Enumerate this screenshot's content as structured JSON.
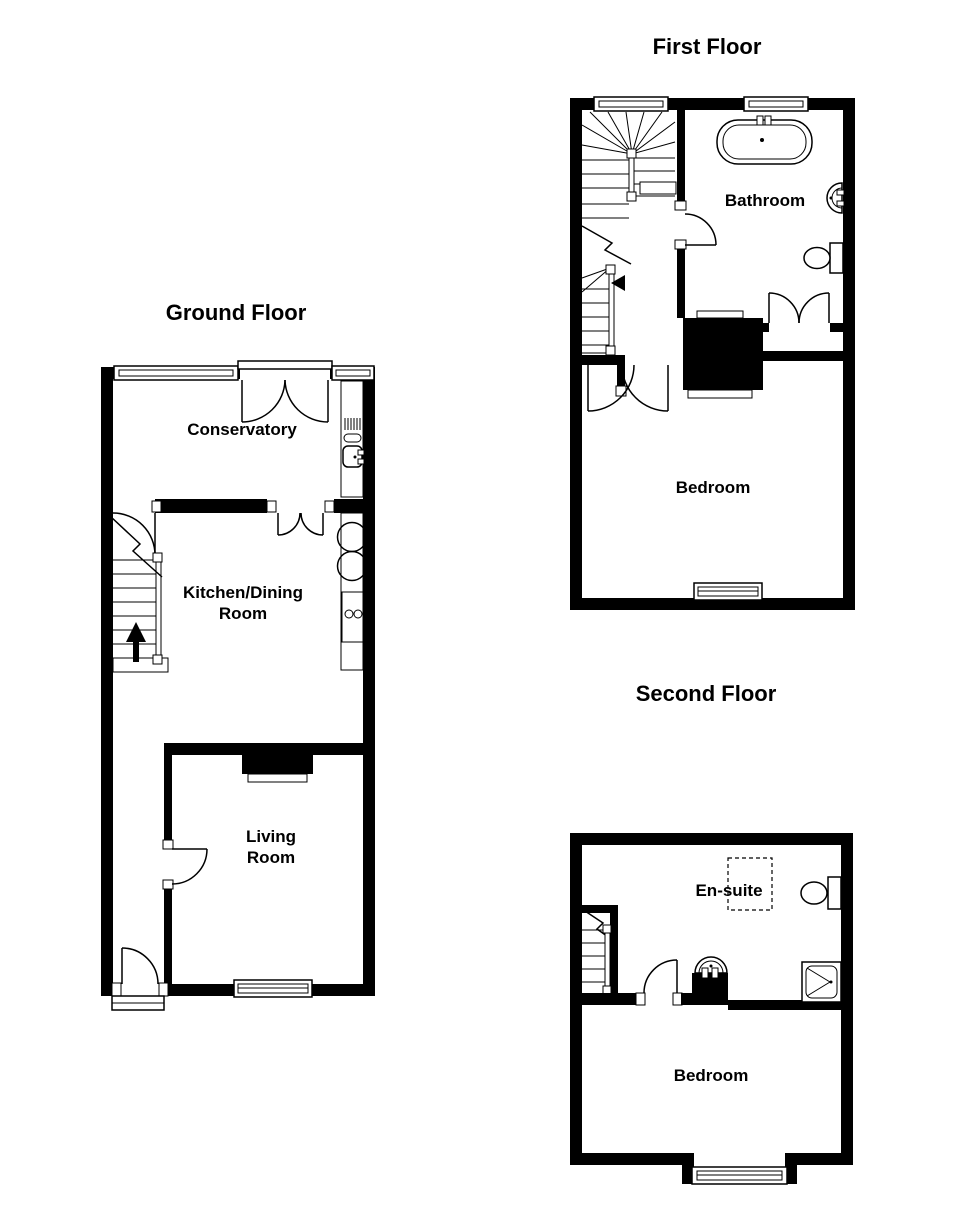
{
  "colors": {
    "wall": "#000000",
    "background": "#ffffff",
    "line": "#000000"
  },
  "floors": {
    "ground": {
      "title": "Ground Floor",
      "rooms": {
        "conservatory": "Conservatory",
        "kitchen_line1": "Kitchen/Dining",
        "kitchen_line2": "Room",
        "living_line1": "Living",
        "living_line2": "Room"
      }
    },
    "first": {
      "title": "First Floor",
      "rooms": {
        "bathroom": "Bathroom",
        "bedroom": "Bedroom"
      }
    },
    "second": {
      "title": "Second Floor",
      "rooms": {
        "ensuite": "En-suite",
        "bedroom": "Bedroom"
      }
    }
  }
}
